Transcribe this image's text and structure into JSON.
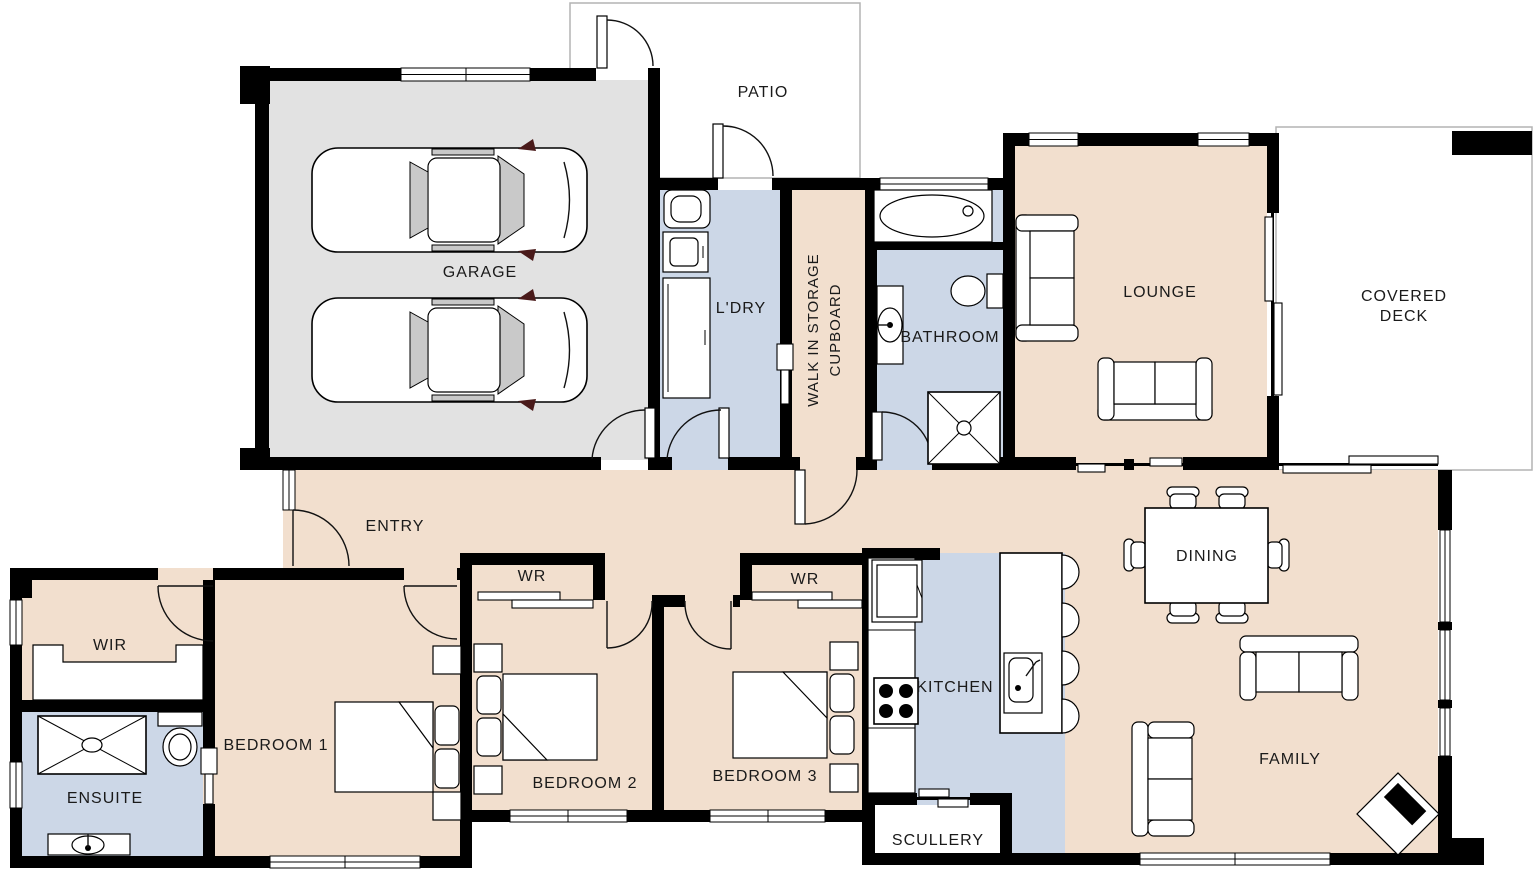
{
  "colors": {
    "floor_interior": "#f2dfce",
    "floor_wet_area": "#ccd7e7",
    "floor_garage": "#e2e2e2",
    "wall": "#000000",
    "outdoor_outline": "#b3b3b3"
  },
  "rooms": {
    "garage": {
      "label": "GARAGE"
    },
    "patio": {
      "label": "PATIO"
    },
    "laundry": {
      "label": "L'DRY"
    },
    "storage_cupboard": {
      "line1": "WALK IN STORAGE",
      "line2": "CUPBOARD"
    },
    "bathroom": {
      "label": "BATHROOM"
    },
    "lounge": {
      "label": "LOUNGE"
    },
    "covered_deck": {
      "line1": "COVERED",
      "line2": "DECK"
    },
    "entry": {
      "label": "ENTRY"
    },
    "wir": {
      "label": "WIR"
    },
    "ensuite": {
      "label": "ENSUITE"
    },
    "bedroom1": {
      "label": "BEDROOM 1"
    },
    "bedroom2": {
      "label": "BEDROOM 2"
    },
    "bedroom3": {
      "label": "BEDROOM 3"
    },
    "wr_bedroom2": {
      "label": "WR"
    },
    "wr_bedroom3": {
      "label": "WR"
    },
    "kitchen": {
      "label": "KITCHEN"
    },
    "scullery": {
      "label": "SCULLERY"
    },
    "dining": {
      "label": "DINING"
    },
    "family": {
      "label": "FAMILY"
    }
  },
  "furniture": {
    "garage": [
      "car",
      "car"
    ],
    "lounge": [
      "sofa",
      "sofa"
    ],
    "family": [
      "sofa",
      "sofa",
      "fireplace"
    ],
    "dining": [
      "dining-table",
      "chair x6"
    ],
    "kitchen": [
      "fridge",
      "cooktop",
      "island-bench",
      "sink",
      "stool x4"
    ],
    "bathroom": [
      "bathtub",
      "vanity-basin",
      "toilet",
      "shower"
    ],
    "ensuite": [
      "shower",
      "toilet",
      "vanity-basin"
    ],
    "laundry": [
      "laundry-tub",
      "washer",
      "cabinet"
    ],
    "bedroom1": [
      "double-bed",
      "nightstand x2"
    ],
    "bedroom2": [
      "double-bed",
      "nightstand x2"
    ],
    "bedroom3": [
      "double-bed",
      "nightstand x2"
    ],
    "wir": [
      "wardrobe"
    ]
  }
}
